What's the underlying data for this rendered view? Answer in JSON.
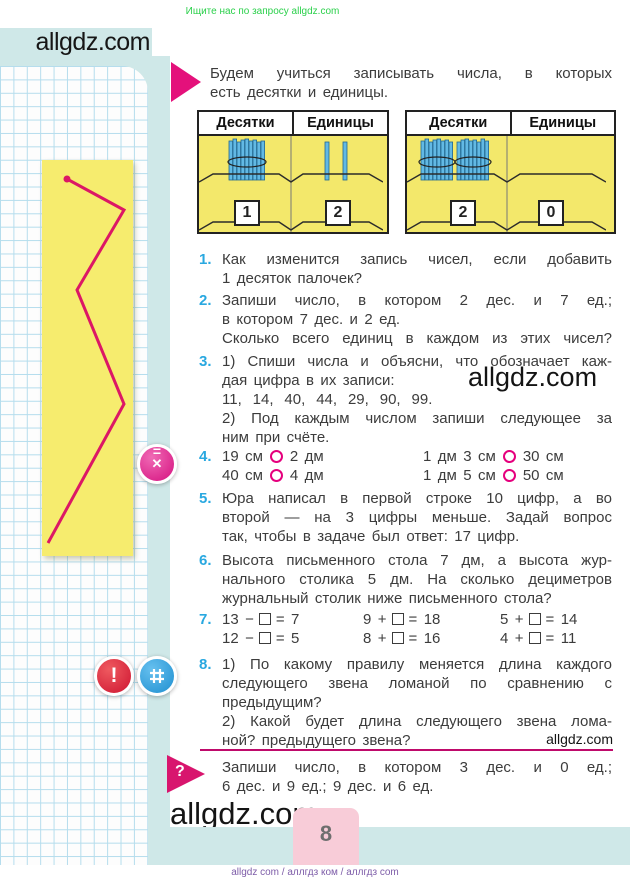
{
  "banner": {
    "text": "Ищите нас по запросу allgdz.com"
  },
  "header": {
    "logo": "allgdz.com"
  },
  "intro": {
    "lines": [
      "Будем учиться записывать числа, в которых",
      "есть десятки и единицы."
    ]
  },
  "place_tables": [
    {
      "tens_header": "Десятки",
      "units_header": "Единицы",
      "tens_card": "1",
      "units_card": "2"
    },
    {
      "tens_header": "Десятки",
      "units_header": "Единицы",
      "tens_card": "2",
      "units_card": "0"
    }
  ],
  "tasks": {
    "t1": {
      "num": "1.",
      "lines": [
        "Как изменится запись чисел, если добавить",
        "1 десяток палочек?"
      ]
    },
    "t2": {
      "num": "2.",
      "lines": [
        "Запиши число, в котором 2 дес. и 7 ед.;",
        "в котором 7 дес. и 2 ед.",
        "Сколько всего единиц в каждом из этих чисел?"
      ]
    },
    "t3": {
      "num": "3.",
      "lines": [
        "1) Спиши числа и объясни, что обозначает каж-",
        "дая цифра в их записи:",
        "11, 14, 40, 44, 29, 90, 99.",
        "2) Под каждым числом запиши следующее за",
        "ним при счёте."
      ]
    },
    "t4": {
      "num": "4.",
      "rows": [
        {
          "l1": "19 см",
          "l2": "2 дм",
          "r1": "1 дм 3 см",
          "r2": "30 см"
        },
        {
          "l1": "40 см",
          "l2": "4 дм",
          "r1": "1 дм 5 см",
          "r2": "50 см"
        }
      ]
    },
    "t5": {
      "num": "5.",
      "lines": [
        "Юра написал в первой строке 10 цифр, а во",
        "второй — на 3 цифры меньше. Задай вопрос",
        "так, чтобы в задаче был ответ: 17 цифр."
      ]
    },
    "t6": {
      "num": "6.",
      "lines": [
        "Высота письменного стола 7 дм, а высота жур-",
        "нального столика 5 дм. На сколько дециметров",
        "журнальный столик ниже письменного стола?"
      ]
    },
    "t7": {
      "num": "7.",
      "eqs": [
        {
          "pre": "13 −",
          "post": "= 7"
        },
        {
          "pre": "9 +",
          "post": "= 18"
        },
        {
          "pre": "5 +",
          "post": "= 14"
        },
        {
          "pre": "12 −",
          "post": "= 5"
        },
        {
          "pre": "8 +",
          "post": "= 16"
        },
        {
          "pre": "4 +",
          "post": "= 11"
        }
      ]
    },
    "t8": {
      "num": "8.",
      "lines": [
        "1) По какому правилу меняется длина каждого",
        "следующего звена ломаной по сравнению с",
        "предыдущим?",
        "2) Какой будет длина следующего звена лома-",
        "ной? предыдущего звена?"
      ]
    }
  },
  "question_block": {
    "icon": "?",
    "lines": [
      "Запиши число, в котором 3 дес. и 0 ед.;",
      "6 дес. и 9 ед.; 9 дес. и 6 ед."
    ]
  },
  "watermarks": {
    "inline": "allgdz.com",
    "side": "allgdz.com",
    "bottom": "allgdz.com",
    "footer": "allgdz com  /  аллгдз ком  /  аллгдз com"
  },
  "page_number": "8",
  "colors": {
    "accent_pink": "#d8156e",
    "task_number_blue": "#29a8e0",
    "table_yellow": "#f3e86b",
    "sidebar_cyan": "#cfe8e8"
  }
}
